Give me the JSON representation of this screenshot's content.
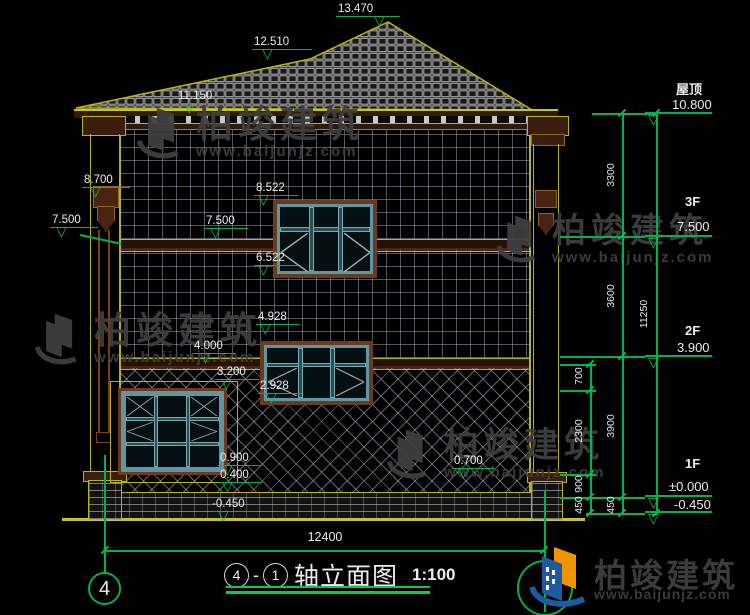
{
  "colors": {
    "background": "#000000",
    "annotation_green": "#00b14f",
    "outline_yellow": "#b8b410",
    "trim_brown": "#6e3a1c",
    "window_teal": "#5b97a5",
    "text_white": "#ececec",
    "watermark_gray": "#3f3f3f",
    "brand_blue": "#1e5aa0",
    "brand_orange": "#f29400"
  },
  "icons": {
    "level_marker": "▽"
  },
  "watermark": {
    "company": "柏竣建筑",
    "url": "www.baijunjz.com"
  },
  "brand": {
    "company": "柏竣建筑",
    "url": "www.baijunjz.com"
  },
  "markers": {
    "peak": "13.470",
    "ridge": "12.510",
    "eaves": "11.150",
    "gutter": "8.700",
    "porch_band": "7.500",
    "w3_head": "8.522",
    "f3_band": "7.500",
    "w3_sill": "6.522",
    "w2_head": "4.928",
    "f2_band": "4.000",
    "w1_head": "3.200",
    "w2_sill": "2.928",
    "w1_sill": "0.900",
    "plinth_top": "0.400",
    "ground": "-0.450",
    "right_base": "0.700"
  },
  "levels": [
    {
      "name": "屋顶",
      "value": "10.800"
    },
    {
      "name": "3F",
      "value": "7.500"
    },
    {
      "name": "2F",
      "value": "3.900"
    },
    {
      "name": "1F",
      "value": "±0.000"
    },
    {
      "name": "",
      "value": "-0.450"
    }
  ],
  "dimensions": {
    "inner": [
      "700",
      "2300",
      "900",
      "450"
    ],
    "middle": [
      "3300",
      "3600",
      "3900",
      "450"
    ],
    "outer": "11250",
    "total_width": "12400"
  },
  "axes": {
    "left_bubble": "4"
  },
  "title": {
    "axis_start": "4",
    "sep": "-",
    "axis_end": "1",
    "name": "轴立面图",
    "scale": "1:100"
  }
}
